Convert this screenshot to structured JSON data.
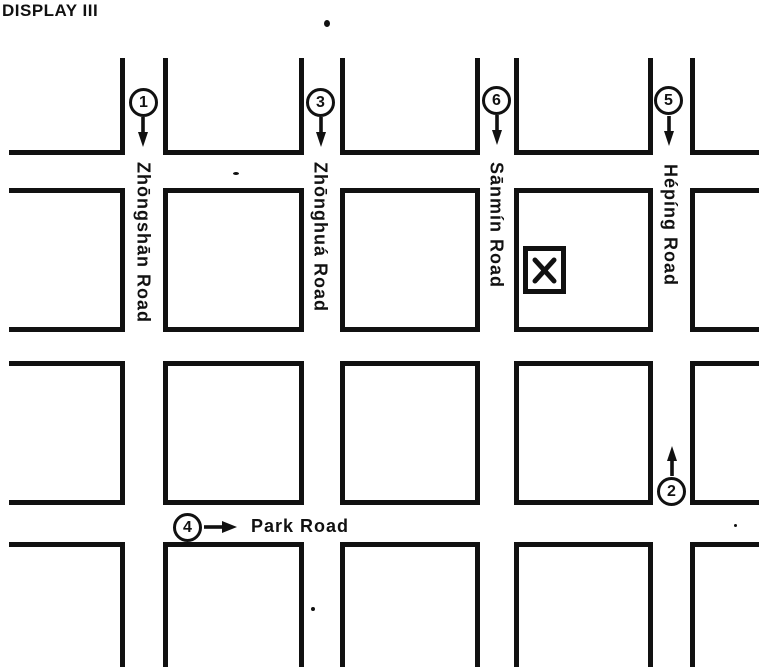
{
  "title": "DISPLAY III",
  "roads": {
    "vertical": [
      {
        "name": "Zhōngshān Road"
      },
      {
        "name": "Zhōnghuá Road"
      },
      {
        "name": "Sānmín Road"
      },
      {
        "name": "Hépíng Road"
      }
    ],
    "horizontal": {
      "name": "Park Road"
    }
  },
  "markers": [
    {
      "label": "1",
      "direction": "down"
    },
    {
      "label": "3",
      "direction": "down"
    },
    {
      "label": "6",
      "direction": "down"
    },
    {
      "label": "5",
      "direction": "down"
    },
    {
      "label": "4",
      "direction": "right"
    },
    {
      "label": "2",
      "direction": "up"
    }
  ],
  "destination": {
    "symbol": "X"
  },
  "colors": {
    "ink": "#111111",
    "paper": "#ffffff"
  }
}
